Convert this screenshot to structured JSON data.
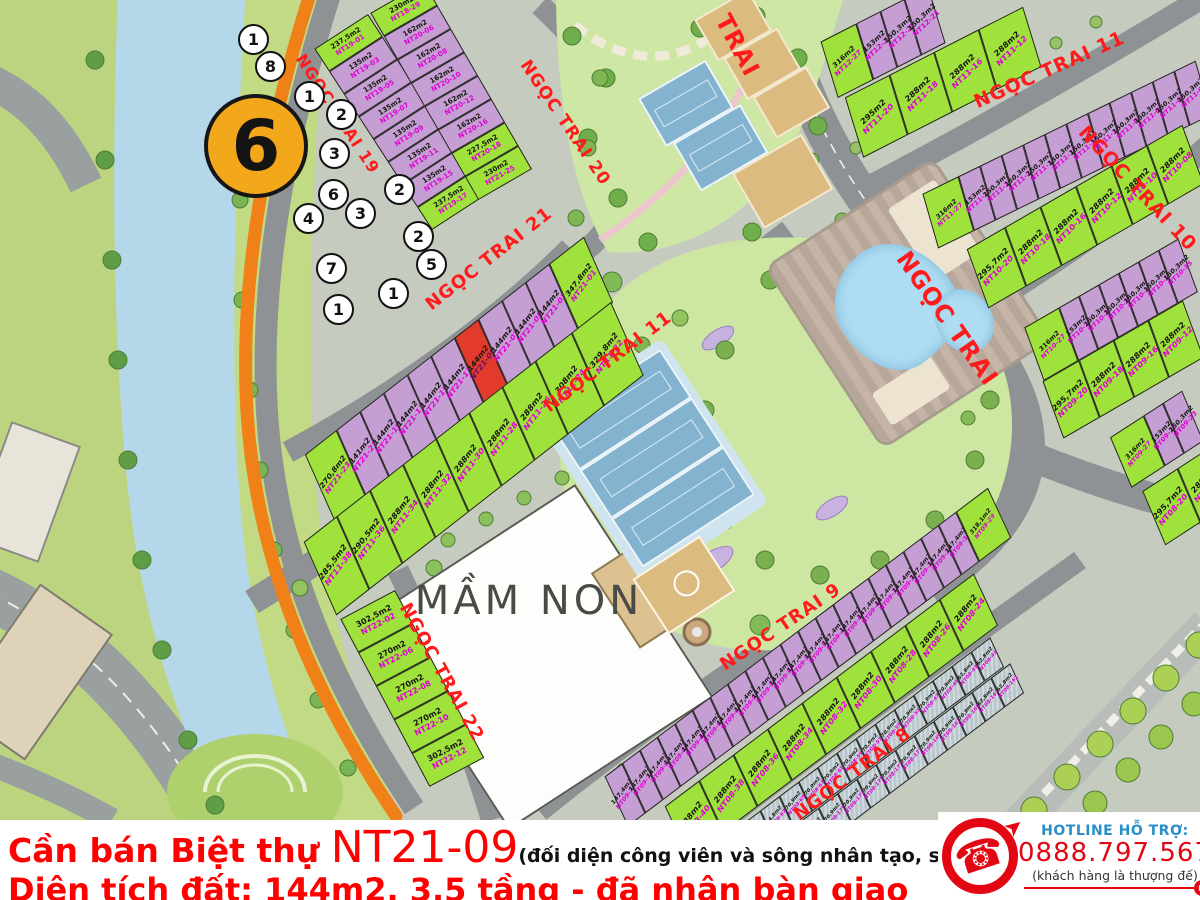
{
  "banner": {
    "line1_prefix": "Cần bán Biệt thự ",
    "line1_lot": "NT21-09",
    "line1_note": "(đối diện công viên và sông nhân tạo, sau nhà là Công viên lớn)",
    "line2": "Diện tích đất: 144m2, 3,5 tầng - đã nhận bàn giao",
    "text_color": "#ff0000"
  },
  "hotline": {
    "title": "HOTLINE HỖ TRỢ:",
    "number": "0888.797.567",
    "tagline": "(khách hàng là thượng đế)",
    "title_color": "#2a8fc7",
    "number_color": "#e30613"
  },
  "map": {
    "zone_badge": "6",
    "kindergarten_label": "MẦM NON",
    "poi_markers": [
      "1",
      "8",
      "1",
      "2",
      "3",
      "6",
      "4",
      "3",
      "2",
      "2",
      "5",
      "7",
      "1",
      "1"
    ],
    "legend_colors": {
      "villa_green": "#9fe23c",
      "villa_purple": "#c59fd4",
      "highlight_red": "#e23a2c",
      "shophouse_gray": "#b9c7cd",
      "boundary_orange": "#f08119",
      "street_text": "#ff1b1b"
    },
    "streets": [
      {
        "key": "s19",
        "name": "NGỌC TRAI 19"
      },
      {
        "key": "s20",
        "name": "NGỌC TRAI 20"
      },
      {
        "key": "s21",
        "name": "NGỌC TRAI 21"
      },
      {
        "key": "s11w",
        "name": "NGỌC TRAI 11"
      },
      {
        "key": "s22",
        "name": "NGỌC TRAI 22"
      },
      {
        "key": "s11e",
        "name": "NGỌC TRAI 11"
      },
      {
        "key": "s10",
        "name": "NGỌC TRAI 10"
      },
      {
        "key": "smain",
        "name": "NGỌC TRAI"
      },
      {
        "key": "strai",
        "name": "TRAI"
      },
      {
        "key": "s9",
        "name": "NGỌC TRAI 9"
      },
      {
        "key": "s8",
        "name": "NGỌC TRAI 8"
      }
    ],
    "blocks": [
      {
        "key": "nt19",
        "plots": [
          {
            "id": "NT19-01",
            "area": "237,5m2",
            "c": "g"
          },
          {
            "id": "NT19-03",
            "area": "135m2",
            "c": "p"
          },
          {
            "id": "NT19-05",
            "area": "135m2",
            "c": "p"
          },
          {
            "id": "NT19-07",
            "area": "135m2",
            "c": "p"
          },
          {
            "id": "NT19-09",
            "area": "135m2",
            "c": "p"
          },
          {
            "id": "NT19-11",
            "area": "135m2",
            "c": "p"
          },
          {
            "id": "NT19-15",
            "area": "135m2",
            "c": "p"
          },
          {
            "id": "NT19-17",
            "area": "237,5m2",
            "c": "g"
          }
        ]
      },
      {
        "key": "nt20",
        "plots": [
          {
            "id": "NT18-29",
            "area": "230m2",
            "c": "g"
          },
          {
            "id": "NT20-06",
            "area": "162m2",
            "c": "p"
          },
          {
            "id": "NT20-08",
            "area": "162m2",
            "c": "p"
          },
          {
            "id": "NT20-10",
            "area": "162m2",
            "c": "p"
          },
          {
            "id": "NT20-12",
            "area": "162m2",
            "c": "p"
          },
          {
            "id": "NT20-16",
            "area": "162m2",
            "c": "p"
          },
          {
            "id": "NT20-18",
            "area": "227,5m2",
            "c": "g"
          },
          {
            "id": "NT21-25",
            "area": "230m2",
            "c": "g"
          }
        ]
      },
      {
        "key": "nt21",
        "plots": [
          {
            "id": "NT21-23",
            "area": "270,8m2",
            "c": "g",
            "w": 40
          },
          {
            "id": "NT21-21",
            "area": "141m2",
            "c": "p"
          },
          {
            "id": "NT21-19",
            "area": "144m2",
            "c": "p"
          },
          {
            "id": "NT21-17",
            "area": "144m2",
            "c": "p"
          },
          {
            "id": "NT21-15",
            "area": "144m2",
            "c": "p"
          },
          {
            "id": "NT21-11",
            "area": "144m2",
            "c": "p"
          },
          {
            "id": "NT21-09",
            "area": "144m2",
            "c": "r"
          },
          {
            "id": "NT21-07",
            "area": "144m2",
            "c": "p"
          },
          {
            "id": "NT21-05",
            "area": "144m2",
            "c": "p"
          },
          {
            "id": "NT21-03",
            "area": "144m2",
            "c": "p"
          },
          {
            "id": "NT21-01",
            "area": "347,8m2",
            "c": "g",
            "w": 44
          }
        ]
      },
      {
        "key": "nt11w",
        "plots": [
          {
            "id": "NT11-38",
            "area": "285,5m2",
            "c": "g"
          },
          {
            "id": "NT11-36",
            "area": "290,5m2",
            "c": "g"
          },
          {
            "id": "NT11-34",
            "area": "288m2",
            "c": "g"
          },
          {
            "id": "NT11-32",
            "area": "288m2",
            "c": "g"
          },
          {
            "id": "NT11-30",
            "area": "288m2",
            "c": "g"
          },
          {
            "id": "NT11-28",
            "area": "288m2",
            "c": "g"
          },
          {
            "id": "NT11-26",
            "area": "288m2",
            "c": "g"
          },
          {
            "id": "NT11-24",
            "area": "308m2",
            "c": "g",
            "w": 46
          },
          {
            "id": "NT11-22",
            "area": "329,8m2",
            "c": "g",
            "w": 50
          }
        ]
      },
      {
        "key": "nt22",
        "plots": [
          {
            "id": "NT22-02",
            "area": "302,5m2",
            "c": "g"
          },
          {
            "id": "NT22-06",
            "area": "270m2",
            "c": "g"
          },
          {
            "id": "NT22-08",
            "area": "270m2",
            "c": "g"
          },
          {
            "id": "NT22-10",
            "area": "270m2",
            "c": "g"
          },
          {
            "id": "NT22-12",
            "area": "302,5m2",
            "c": "g"
          }
        ]
      },
      {
        "key": "nt12",
        "plots": [
          {
            "id": "NT12-27",
            "area": "316m2",
            "c": "g",
            "w": 40
          },
          {
            "id": "NT12-25",
            "area": "153m2",
            "c": "p"
          },
          {
            "id": "NT12-23",
            "area": "150,3m2",
            "c": "p"
          },
          {
            "id": "NT12-21",
            "area": "150,3m2",
            "c": "p"
          }
        ]
      },
      {
        "key": "nt11e_g",
        "plots": [
          {
            "id": "NT11-20",
            "area": "295m2",
            "c": "g"
          },
          {
            "id": "NT11-18",
            "area": "288m2",
            "c": "g"
          },
          {
            "id": "NT11-16",
            "area": "288m2",
            "c": "g"
          },
          {
            "id": "NT11-12",
            "area": "288m2",
            "c": "g"
          }
        ]
      },
      {
        "key": "nt11e_p",
        "plots": [
          {
            "id": "NT11-27",
            "area": "316m2",
            "c": "g",
            "w": 40
          },
          {
            "id": "NT11-25",
            "area": "153m2",
            "c": "p"
          },
          {
            "id": "NT11-23",
            "area": "150,3m2",
            "c": "p"
          },
          {
            "id": "NT11-21",
            "area": "150,3m2",
            "c": "p"
          },
          {
            "id": "NT11-19",
            "area": "150,3m2",
            "c": "p"
          },
          {
            "id": "NT11-17",
            "area": "150,3m2",
            "c": "p"
          },
          {
            "id": "NT11-15",
            "area": "150,3m2",
            "c": "p"
          },
          {
            "id": "NT11-11",
            "area": "150,3m2",
            "c": "p"
          },
          {
            "id": "NT11-09",
            "area": "150,3m2",
            "c": "p"
          },
          {
            "id": "NT11-07",
            "area": "150,3m2",
            "c": "p"
          },
          {
            "id": "NT11-05",
            "area": "150,3m2",
            "c": "p"
          },
          {
            "id": "NT11-03",
            "area": "150,3m2",
            "c": "p"
          }
        ]
      },
      {
        "key": "nt10n",
        "plots": [
          {
            "id": "NT10-20",
            "area": "295,7m2",
            "c": "g",
            "w": 44
          },
          {
            "id": "NT10-18",
            "area": "288m2",
            "c": "g"
          },
          {
            "id": "NT10-16",
            "area": "288m2",
            "c": "g"
          },
          {
            "id": "NT10-12",
            "area": "288m2",
            "c": "g"
          },
          {
            "id": "NT10-10",
            "area": "288m2",
            "c": "g"
          },
          {
            "id": "NT10-08",
            "area": "288m2",
            "c": "g"
          }
        ]
      },
      {
        "key": "nt10s",
        "plots": [
          {
            "id": "NT10-27",
            "area": "316m2",
            "c": "g",
            "w": 40
          },
          {
            "id": "NT10-25",
            "area": "153m2",
            "c": "p"
          },
          {
            "id": "NT10-23",
            "area": "150,3m2",
            "c": "p"
          },
          {
            "id": "NT10-21",
            "area": "150,3m2",
            "c": "p"
          },
          {
            "id": "NT10-19",
            "area": "150,3m2",
            "c": "p"
          },
          {
            "id": "NT10-17",
            "area": "150,3m2",
            "c": "p"
          },
          {
            "id": "NT10-15",
            "area": "150,3m2",
            "c": "p"
          }
        ]
      },
      {
        "key": "nt09n",
        "plots": [
          {
            "id": "NT09-20",
            "area": "295,7m2",
            "c": "g",
            "w": 42
          },
          {
            "id": "NT09-18",
            "area": "288m2",
            "c": "g"
          },
          {
            "id": "NT09-16",
            "area": "288m2",
            "c": "g"
          },
          {
            "id": "NT09-12",
            "area": "288m2",
            "c": "g"
          }
        ]
      },
      {
        "key": "nt09s",
        "plots": [
          {
            "id": "NT09-27",
            "area": "316m2",
            "c": "g",
            "w": 40
          },
          {
            "id": "NT09-25",
            "area": "153m2",
            "c": "p"
          },
          {
            "id": "NT09-23",
            "area": "150,3m2",
            "c": "p"
          }
        ]
      },
      {
        "key": "nt08n",
        "plots": [
          {
            "id": "NT08-20",
            "area": "295,7m2",
            "c": "g",
            "w": 42
          },
          {
            "id": "NT08-18",
            "area": "288m2",
            "c": "g"
          }
        ]
      },
      {
        "key": "nt09odd",
        "plots": [
          {
            "id": "NT09-73",
            "area": "147,4m2",
            "c": "p"
          },
          {
            "id": "NT09-71",
            "area": "147,4m2",
            "c": "p"
          },
          {
            "id": "NT09-69",
            "area": "147,4m2",
            "c": "p"
          },
          {
            "id": "NT09-67",
            "area": "147,4m2",
            "c": "p"
          },
          {
            "id": "NT09-65",
            "area": "147,4m2",
            "c": "p"
          },
          {
            "id": "NT09-63",
            "area": "147,4m2",
            "c": "p"
          },
          {
            "id": "NT09-61",
            "area": "147,4m2",
            "c": "p"
          },
          {
            "id": "NT09-59",
            "area": "147,4m2",
            "c": "p"
          },
          {
            "id": "NT09-57",
            "area": "147,4m2",
            "c": "p"
          },
          {
            "id": "NT09-55",
            "area": "147,4m2",
            "c": "p"
          },
          {
            "id": "NT09-53",
            "area": "147,4m2",
            "c": "p"
          },
          {
            "id": "NT09-51",
            "area": "147,4m2",
            "c": "p"
          },
          {
            "id": "NT09-47",
            "area": "147,4m2",
            "c": "p"
          },
          {
            "id": "NT09-45",
            "area": "147,4m2",
            "c": "p"
          },
          {
            "id": "NT09-41",
            "area": "147,4m2",
            "c": "p"
          },
          {
            "id": "NT09-39",
            "area": "147,4m2",
            "c": "p"
          },
          {
            "id": "NT09-37",
            "area": "147,4m2",
            "c": "p"
          },
          {
            "id": "NT09-35",
            "area": "147,4m2",
            "c": "p"
          },
          {
            "id": "NT09-33",
            "area": "147,4m2",
            "c": "p"
          },
          {
            "id": "NT09-31",
            "area": "147,4m2",
            "c": "p"
          },
          {
            "id": "NT09-29",
            "area": "318,1m2",
            "c": "g",
            "w": 40
          }
        ]
      },
      {
        "key": "nt08even",
        "plots": [
          {
            "id": "NT08-40",
            "area": "288m2",
            "c": "g"
          },
          {
            "id": "NT08-38",
            "area": "288m2",
            "c": "g"
          },
          {
            "id": "NT08-36",
            "area": "288m2",
            "c": "g"
          },
          {
            "id": "NT08-34",
            "area": "288m2",
            "c": "g"
          },
          {
            "id": "NT08-32",
            "area": "288m2",
            "c": "g"
          },
          {
            "id": "NT08-30",
            "area": "288m2",
            "c": "g"
          },
          {
            "id": "NT08-28",
            "area": "288m2",
            "c": "g"
          },
          {
            "id": "NT08-26",
            "area": "288m2",
            "c": "g"
          },
          {
            "id": "NT08-24",
            "area": "288m2",
            "c": "g"
          }
        ]
      },
      {
        "key": "shop_n",
        "plots": [
          {
            "id": "NT08-73",
            "area": "94,8m2",
            "c": "s"
          },
          {
            "id": "NT08-71",
            "area": "94,8m2",
            "c": "s"
          },
          {
            "id": "NT08-69",
            "area": "94,8m2",
            "c": "s"
          },
          {
            "id": "NT08-67",
            "area": "94,8m2",
            "c": "s"
          },
          {
            "id": "NT08-65",
            "area": "70,9m2",
            "c": "s"
          },
          {
            "id": "NT08-63",
            "area": "70,9m2",
            "c": "s"
          },
          {
            "id": "NT08-61",
            "area": "70,9m2",
            "c": "s"
          },
          {
            "id": "NT08-59",
            "area": "70,9m2",
            "c": "s"
          },
          {
            "id": "NT08-57",
            "area": "70,9m2",
            "c": "s"
          },
          {
            "id": "NT08-55",
            "area": "70,9m2",
            "c": "s"
          },
          {
            "id": "NT08-51",
            "area": "70,9m2",
            "c": "s"
          },
          {
            "id": "NT08-47",
            "area": "70,9m2",
            "c": "s"
          },
          {
            "id": "NT08-45",
            "area": "70,9m2",
            "c": "s"
          },
          {
            "id": "NT08-43",
            "area": "62,8m2",
            "c": "s"
          },
          {
            "id": "NT08-41",
            "area": "62,8m2",
            "c": "s"
          }
        ]
      },
      {
        "key": "shop_s",
        "plots": [
          {
            "id": "NT08-189",
            "area": "94,8m2",
            "c": "s"
          },
          {
            "id": "NT08-187",
            "area": "94,8m2",
            "c": "s"
          },
          {
            "id": "NT08-185",
            "area": "94,8m2",
            "c": "s"
          },
          {
            "id": "NT08-183",
            "area": "70,9m2",
            "c": "s"
          },
          {
            "id": "NT08-181",
            "area": "70,9m2",
            "c": "s"
          },
          {
            "id": "NT08-179",
            "area": "70,9m2",
            "c": "s"
          },
          {
            "id": "NT08-177",
            "area": "70,9m2",
            "c": "s"
          },
          {
            "id": "NT08-175",
            "area": "70,9m2",
            "c": "s"
          },
          {
            "id": "NT08-173",
            "area": "70,9m2",
            "c": "s"
          },
          {
            "id": "NT08-171",
            "area": "70,9m2",
            "c": "s"
          },
          {
            "id": "NT08-169",
            "area": "70,9m2",
            "c": "s"
          },
          {
            "id": "NT08-167",
            "area": "70,9m2",
            "c": "s"
          },
          {
            "id": "NT08-165",
            "area": "70,9m2",
            "c": "s"
          },
          {
            "id": "NT08-163",
            "area": "62,8m2",
            "c": "s"
          },
          {
            "id": "NT08-161",
            "area": "62,8m2",
            "c": "s"
          }
        ]
      }
    ]
  }
}
